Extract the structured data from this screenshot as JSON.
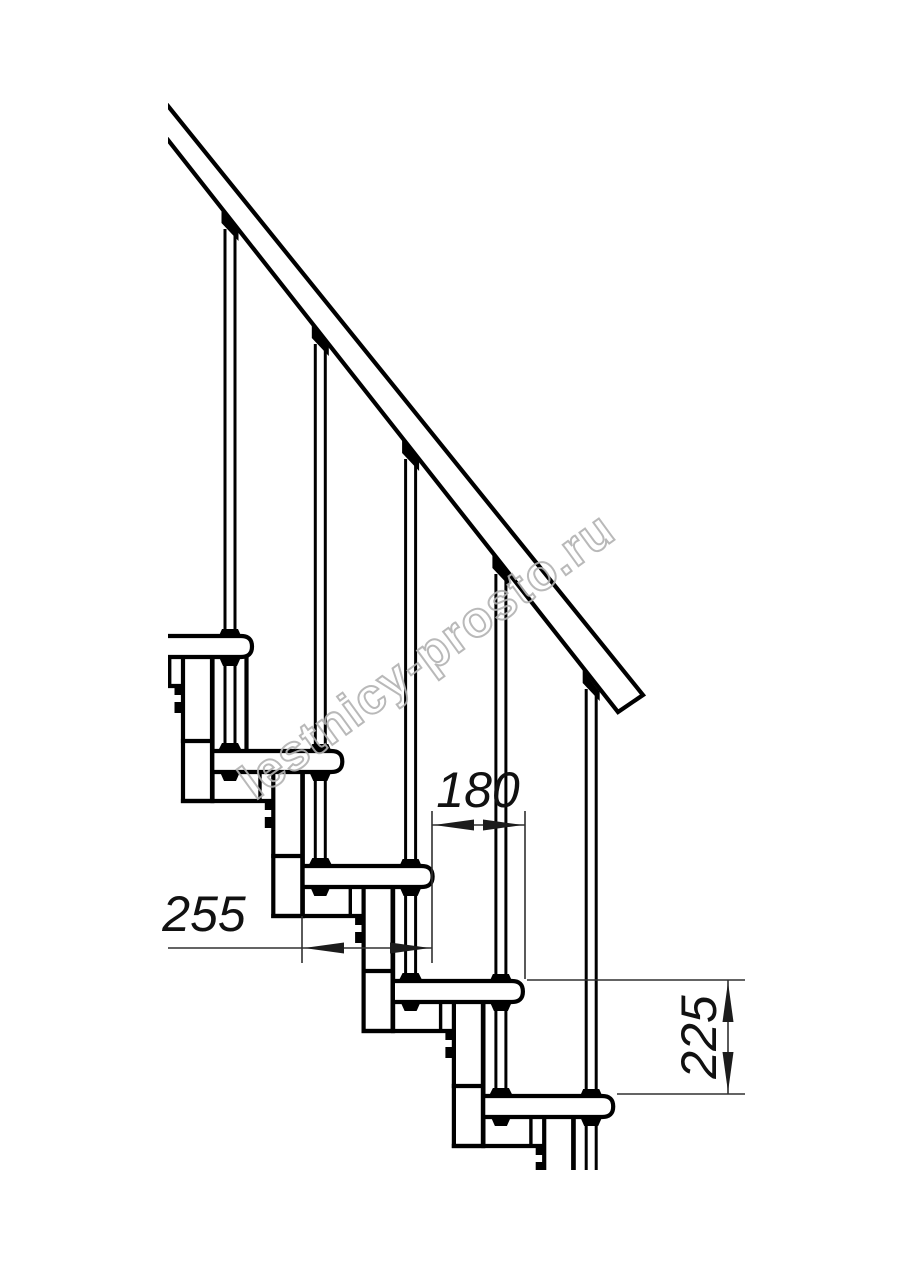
{
  "page": {
    "background": "#ffffff",
    "type": "technical-drawing",
    "subject": "modular staircase side elevation with handrail and dimensions"
  },
  "drawing": {
    "dimensions": [
      {
        "id": "tread-depth",
        "value": "255",
        "orientation": "horizontal"
      },
      {
        "id": "going",
        "value": "180",
        "orientation": "horizontal"
      },
      {
        "id": "rise",
        "value": "225",
        "orientation": "vertical"
      }
    ],
    "colors": {
      "line": "#000000",
      "thin_line": "#303030",
      "watermark": "#b2b2b2",
      "background": "#ffffff"
    }
  },
  "watermark": {
    "text": "lestnicy-prosto.ru"
  }
}
